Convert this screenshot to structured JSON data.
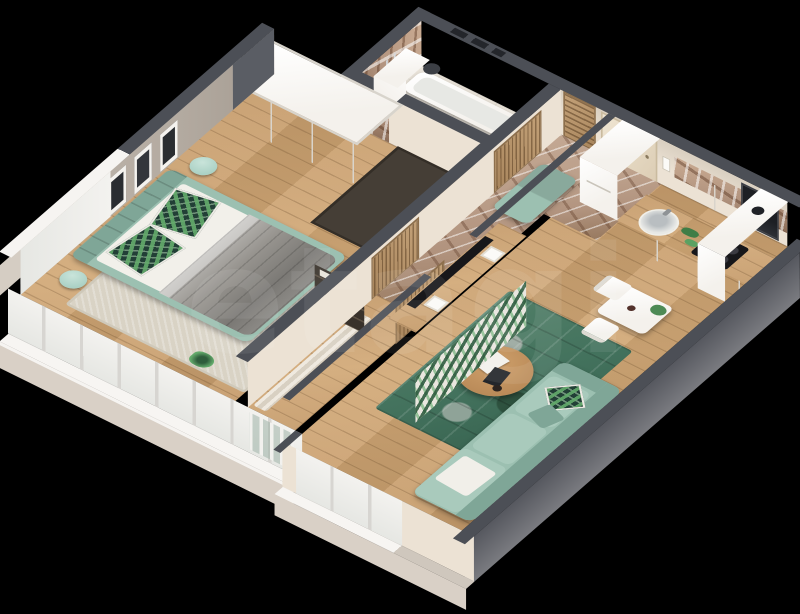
{
  "scene": {
    "description": "Photoreal 3D dollhouse floor-plan render of a one-bedroom apartment viewed from above at an angle, on a black background",
    "background": "#000000"
  },
  "watermark": {
    "text": "etagi"
  },
  "colors": {
    "wood": "#c59b6b",
    "marble": "#b2947f",
    "tile": "#eae4da",
    "wallTop": "#4c4f56",
    "extBeige": "#d9d0c6",
    "extGray": "#75767b",
    "extDark": "#5a5d64",
    "intCream": "#ece2d4",
    "greige": "#b4aba1",
    "white": "#f4f1ec",
    "sage": "#9cc0b1",
    "sageDark": "#7fa697",
    "mint": "#abd1c5",
    "blanket": "#97948f",
    "leafBg": "#223f36",
    "leafGreen": "#63aa6b",
    "rugGreen": "#43725d",
    "rugBeige": "#d9d3c5",
    "black": "#17171a",
    "window": "#f7f5f2"
  },
  "rooms": [
    {
      "name": "bedroom",
      "floor": "wood",
      "furniture": [
        "double-bed",
        "sage-tufted-headboard",
        "gray-quilt",
        "white-sheets",
        "leaf-print-pillows",
        "round-nightstand-left",
        "round-nightstand-right",
        "white-wardrobe",
        "wood-bookshelf",
        "beige-rug",
        "framed-wall-pictures",
        "floor-plant",
        "corner-window"
      ]
    },
    {
      "name": "bathroom",
      "floor": "tile",
      "furniture": [
        "bathtub",
        "round-washbasin",
        "wood-vanity-counter",
        "toilet",
        "tall-white-cabinet",
        "marble-accent-wall",
        "towel-radiator",
        "vent-pipe"
      ]
    },
    {
      "name": "hallway",
      "floor": "marble",
      "furniture": [
        "sage-bench",
        "louvered-door-bathroom",
        "louvered-door-bedroom",
        "louvered-door-living",
        "louvered-closet",
        "entry-door",
        "intercom"
      ]
    },
    {
      "name": "kitchen",
      "floor": "wood",
      "furniture": [
        "fridge",
        "upper-cabinets",
        "wood-countertop",
        "round-sink",
        "induction-cooktop",
        "built-in-oven",
        "marble-backsplash",
        "tall-corner-column",
        "vent-spot",
        "greens-on-counter"
      ]
    },
    {
      "name": "living-room",
      "floor": "wood",
      "furniture": [
        "tv-sideboard-leaf-front",
        "tv",
        "green-patchwork-rug",
        "round-coffee-table",
        "books",
        "sage-sofa",
        "leaf-pillow",
        "white-throw",
        "dining-table",
        "dining-chair-1",
        "dining-chair-2",
        "table-plant",
        "coffee-cup",
        "french-window",
        "curtain",
        "balcony-railing"
      ]
    }
  ]
}
